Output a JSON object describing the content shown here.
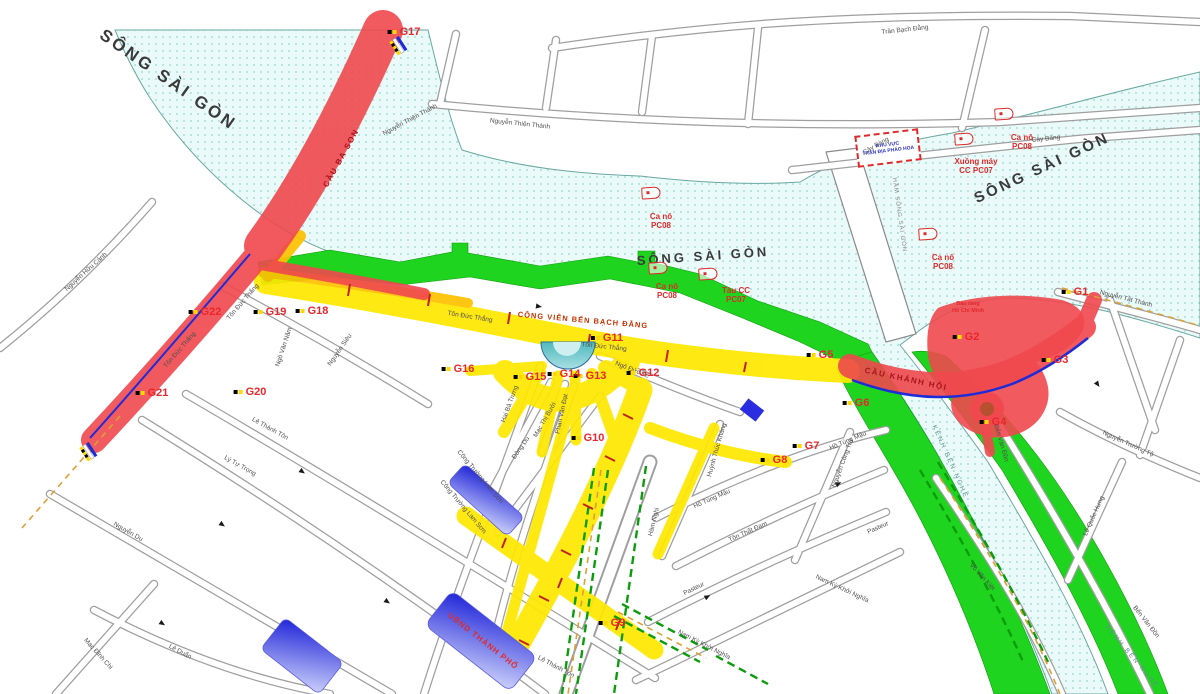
{
  "colors": {
    "water": "#eafaf8",
    "water_dots": "#8fd8d0",
    "park_green": "#1fd41f",
    "closed_road_red": "#f0484e",
    "restricted_road_yellow": "#ffe800",
    "restricted_road_orange": "#ffc100",
    "building_blue": "#1f24d8",
    "checkpoint_red": "#e8262b"
  },
  "river_labels": [
    {
      "t": "SÔNG SÀI GÒN",
      "x": 168,
      "y": 80,
      "r": 35,
      "size": 17
    },
    {
      "t": "SÔNG SÀI GÒN",
      "x": 703,
      "y": 256,
      "r": -4,
      "size": 13
    },
    {
      "t": "SÔNG SÀI GÒN",
      "x": 1042,
      "y": 168,
      "r": -25,
      "size": 15
    }
  ],
  "area_labels": [
    {
      "t": "CÔNG VIÊN BẾN BẠCH ĐẰNG",
      "x": 583,
      "y": 320,
      "r": 5,
      "cls": "park-label"
    },
    {
      "t": "CẦU BA SON",
      "x": 341,
      "y": 158,
      "r": -61,
      "cls": "bridge-label"
    },
    {
      "t": "CẦU KHÁNH HỘI",
      "x": 906,
      "y": 379,
      "r": 12,
      "cls": "bridge-label"
    },
    {
      "t": "KÊNH BẾN NGHÉ",
      "x": 950,
      "y": 462,
      "r": 66,
      "cls": "canal-label"
    },
    {
      "t": "KÊNH BẾN NGHÉ",
      "x": 1132,
      "y": 657,
      "r": 50,
      "cls": "canal-label"
    },
    {
      "t": "HẦM SÔNG SÀI GÒN",
      "x": 899,
      "y": 215,
      "r": 82,
      "cls": "tunnel-label"
    },
    {
      "t": "Bảo tàng",
      "x": 968,
      "y": 304,
      "r": 0,
      "cls": "poi-label"
    },
    {
      "t": "Hồ Chí Minh",
      "x": 968,
      "y": 311,
      "r": 0,
      "cls": "poi-label"
    }
  ],
  "street_labels": [
    {
      "t": "Trần Bạch Đằng",
      "x": 905,
      "y": 30,
      "r": -6
    },
    {
      "t": "Nguyễn Thiện Thành",
      "x": 520,
      "y": 124,
      "r": 6
    },
    {
      "t": "Nguyễn Thiện Thành",
      "x": 410,
      "y": 120,
      "r": -28
    },
    {
      "t": "Cây Bàng",
      "x": 1046,
      "y": 139,
      "r": -6
    },
    {
      "t": "Cây Bàng",
      "x": 876,
      "y": 146,
      "r": -30
    },
    {
      "t": "Nguyễn Tất Thành",
      "x": 1126,
      "y": 299,
      "r": 14
    },
    {
      "t": "Nguyễn Trường Tộ",
      "x": 1128,
      "y": 444,
      "r": 24
    },
    {
      "t": "Bến Vân Đồn",
      "x": 1001,
      "y": 443,
      "r": 74
    },
    {
      "t": "Bến Vân Đồn",
      "x": 1146,
      "y": 622,
      "r": 52
    },
    {
      "t": "Lê Quốc Hưng",
      "x": 1094,
      "y": 516,
      "r": -66
    },
    {
      "t": "Võ Văn Kiệt",
      "x": 982,
      "y": 577,
      "r": 48
    },
    {
      "t": "Nguyễn Hữu Cảnh",
      "x": 86,
      "y": 272,
      "r": -42
    },
    {
      "t": "Tôn Đức Thắng",
      "x": 180,
      "y": 350,
      "r": -49
    },
    {
      "t": "Tôn Đức Thắng",
      "x": 243,
      "y": 302,
      "r": -49
    },
    {
      "t": "Tôn Đức Thắng",
      "x": 470,
      "y": 317,
      "r": 9
    },
    {
      "t": "Tôn Đức Thắng",
      "x": 604,
      "y": 347,
      "r": 6
    },
    {
      "t": "Ngô Văn Năm",
      "x": 284,
      "y": 347,
      "r": -72
    },
    {
      "t": "Nguyễn Siêu",
      "x": 340,
      "y": 350,
      "r": -55
    },
    {
      "t": "Lê Thánh Tôn",
      "x": 270,
      "y": 429,
      "r": 29
    },
    {
      "t": "Lê Thánh Tôn",
      "x": 556,
      "y": 667,
      "r": 28
    },
    {
      "t": "Lý Tự Trọng",
      "x": 240,
      "y": 466,
      "r": 29
    },
    {
      "t": "Nguyễn Du",
      "x": 128,
      "y": 532,
      "r": 30
    },
    {
      "t": "Mạc Đĩnh Chi",
      "x": 98,
      "y": 654,
      "r": 48
    },
    {
      "t": "Lê Duẩn",
      "x": 180,
      "y": 652,
      "r": 28
    },
    {
      "t": "Hai Bà Trưng",
      "x": 510,
      "y": 404,
      "r": -70
    },
    {
      "t": "Mạc Thị Bưởi",
      "x": 545,
      "y": 420,
      "r": -60
    },
    {
      "t": "Phan Văn Đạt",
      "x": 562,
      "y": 414,
      "r": -78
    },
    {
      "t": "Đông Du",
      "x": 521,
      "y": 448,
      "r": -55
    },
    {
      "t": "Ngô Đức Kế",
      "x": 632,
      "y": 370,
      "r": 22
    },
    {
      "t": "Hồ Tùng Mậu",
      "x": 848,
      "y": 441,
      "r": -23
    },
    {
      "t": "Hồ Tùng Mậu",
      "x": 712,
      "y": 499,
      "r": -24
    },
    {
      "t": "Tôn Thất Đạm",
      "x": 748,
      "y": 532,
      "r": -24
    },
    {
      "t": "Pasteur",
      "x": 694,
      "y": 589,
      "r": -26
    },
    {
      "t": "Pasteur",
      "x": 878,
      "y": 528,
      "r": -24
    },
    {
      "t": "Nguyễn Công Trứ",
      "x": 843,
      "y": 463,
      "r": -70
    },
    {
      "t": "Hàm Nghi",
      "x": 654,
      "y": 522,
      "r": -76
    },
    {
      "t": "Nam Kỳ Khởi Nghĩa",
      "x": 704,
      "y": 645,
      "r": 27
    },
    {
      "t": "Nam Kỳ Khởi Nghĩa",
      "x": 842,
      "y": 589,
      "r": 25
    },
    {
      "t": "Huỳnh Thúc Kháng",
      "x": 717,
      "y": 450,
      "r": -74
    },
    {
      "t": "Công Trường Lam Sơn",
      "x": 480,
      "y": 477,
      "r": 50
    },
    {
      "t": "Công Trường Lam Sơn",
      "x": 463,
      "y": 507,
      "r": 50
    }
  ],
  "checkpoints": [
    {
      "id": "G1",
      "x": 1075,
      "y": 292
    },
    {
      "id": "G2",
      "x": 966,
      "y": 337
    },
    {
      "id": "G3",
      "x": 1055,
      "y": 360
    },
    {
      "id": "G4",
      "x": 993,
      "y": 422
    },
    {
      "id": "G5",
      "x": 820,
      "y": 355
    },
    {
      "id": "G6",
      "x": 856,
      "y": 403
    },
    {
      "id": "G7",
      "x": 806,
      "y": 446
    },
    {
      "id": "G8",
      "x": 774,
      "y": 460
    },
    {
      "id": "G9",
      "x": 612,
      "y": 623
    },
    {
      "id": "G10",
      "x": 588,
      "y": 438
    },
    {
      "id": "G11",
      "x": 607,
      "y": 338
    },
    {
      "id": "G12",
      "x": 643,
      "y": 373
    },
    {
      "id": "G13",
      "x": 590,
      "y": 376
    },
    {
      "id": "G14",
      "x": 564,
      "y": 374
    },
    {
      "id": "G15",
      "x": 530,
      "y": 377
    },
    {
      "id": "G16",
      "x": 458,
      "y": 369
    },
    {
      "id": "G17",
      "x": 404,
      "y": 32
    },
    {
      "id": "G18",
      "x": 312,
      "y": 311
    },
    {
      "id": "G19",
      "x": 270,
      "y": 312
    },
    {
      "id": "G20",
      "x": 250,
      "y": 392
    },
    {
      "id": "G21",
      "x": 152,
      "y": 393
    },
    {
      "id": "G22",
      "x": 205,
      "y": 312
    }
  ],
  "boats": [
    {
      "bx": 651,
      "by": 193,
      "cx": 661,
      "cy": 221,
      "l1": "Ca nô",
      "l2": "PC08"
    },
    {
      "bx": 658,
      "by": 268,
      "cx": 667,
      "cy": 291,
      "l1": "Ca nô",
      "l2": "PC08"
    },
    {
      "bx": 708,
      "by": 274,
      "cx": 736,
      "cy": 295,
      "l1": "Tàu CC",
      "l2": "PC07"
    },
    {
      "bx": 928,
      "by": 234,
      "cx": 943,
      "cy": 262,
      "l1": "Ca nô",
      "l2": "PC08"
    },
    {
      "bx": 1004,
      "by": 114,
      "cx": 1022,
      "cy": 142,
      "l1": "Ca nô",
      "l2": "PC08"
    },
    {
      "bx": 964,
      "by": 139,
      "cx": 976,
      "cy": 166,
      "l1": "Xuồng máy",
      "l2": "CC PC07"
    }
  ],
  "fireworks_zone": {
    "line1": "KHU VỰC",
    "line2": "TRẬN ĐỊA PHÁO HOA"
  },
  "buildings": {
    "ubnd": {
      "label": "UBND THÀNH PHỐ"
    }
  }
}
